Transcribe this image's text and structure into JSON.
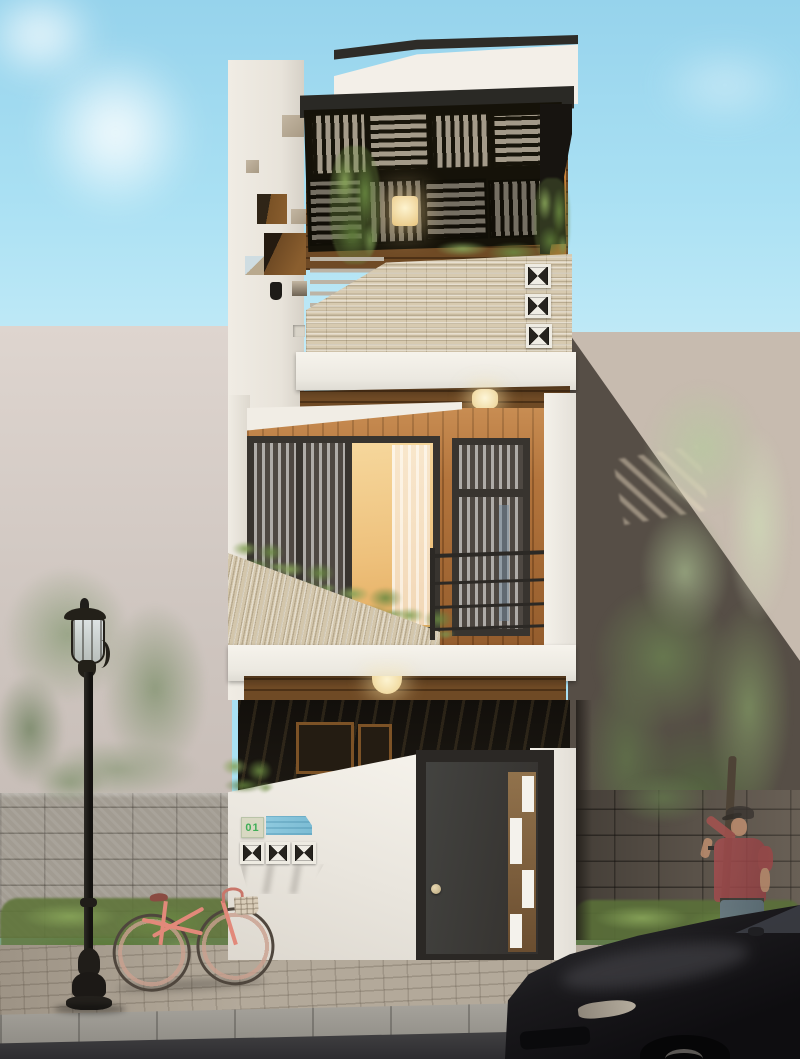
{
  "scene": {
    "type": "photorealistic architectural exterior render",
    "subject": "narrow three-story modern townhouse street elevation, daytime",
    "house_number": "01",
    "floors": [
      {
        "name": "top-floor",
        "features": [
          "dark slatted pergola roof",
          "wood ceiling wall",
          "hanging vine",
          "wall lamp",
          "stone-strip balcony parapet",
          "three ventilation breeze blocks",
          "light railing bars"
        ]
      },
      {
        "name": "middle-floor",
        "features": [
          "vertical wood cladding",
          "three-pane window with warm light and curtains",
          "glazed balcony door with transom",
          "black metal railing",
          "sloped stone planter wall with shrubs",
          "wood soffit with round ceiling light"
        ]
      },
      {
        "name": "ground-floor",
        "features": [
          "dark recessed porch with wood soffit and dome light",
          "white front wall with diagonal top",
          "house number sign",
          "blue name plate",
          "three breeze-block vents",
          "charcoal entry door with round knob and offset white glass strip"
        ]
      }
    ],
    "street_objects": [
      "classic black street lamp",
      "pink vintage bicycle",
      "pedestrian in red polo and jeans tipping a cap",
      "dark parked car",
      "stone fence walls",
      "hedges",
      "trees",
      "cobbled sidewalk",
      "stone curb",
      "asphalt road"
    ],
    "background": [
      "blue sky with white clouds",
      "beige neighbor wall left",
      "shadowed beige wall right with slatted light patch"
    ]
  },
  "palette": {
    "sky_top": "#96d3ec",
    "sky_bottom": "#cdeff9",
    "house_white": "#f3efe8",
    "roof_trim": "#2e2c28",
    "pergola_dark": "#17140a",
    "pergola_light_bar": "#a39a89",
    "wood_cladding": "#b3743c",
    "wood_soffit": "#6f4a25",
    "stone_strip": "#d7cab0",
    "breeze_block_white": "#f0ede5",
    "window_glow": "#eec17c",
    "curtain": "#f6ede8",
    "entry_door": "#3d3a37",
    "door_knob": "#d6c7a0",
    "sign_blue": "#82c0d9",
    "sign_number_green": "#3fae57",
    "fence_left": "#a29c92",
    "fence_right": "#5a5249",
    "hedge_green": "#6a8a45",
    "tree_muted": "#98a486",
    "tree_light": "#bac6a2",
    "tree_dark": "#687a50",
    "bicycle_pink": "#e2897a",
    "shirt_red": "#a84e50",
    "jeans_blue": "#6a7a8e",
    "car_black": "#141316",
    "sidewalk": "#b3a99a",
    "road": "#3a393b",
    "lamp_black": "#23211f"
  }
}
